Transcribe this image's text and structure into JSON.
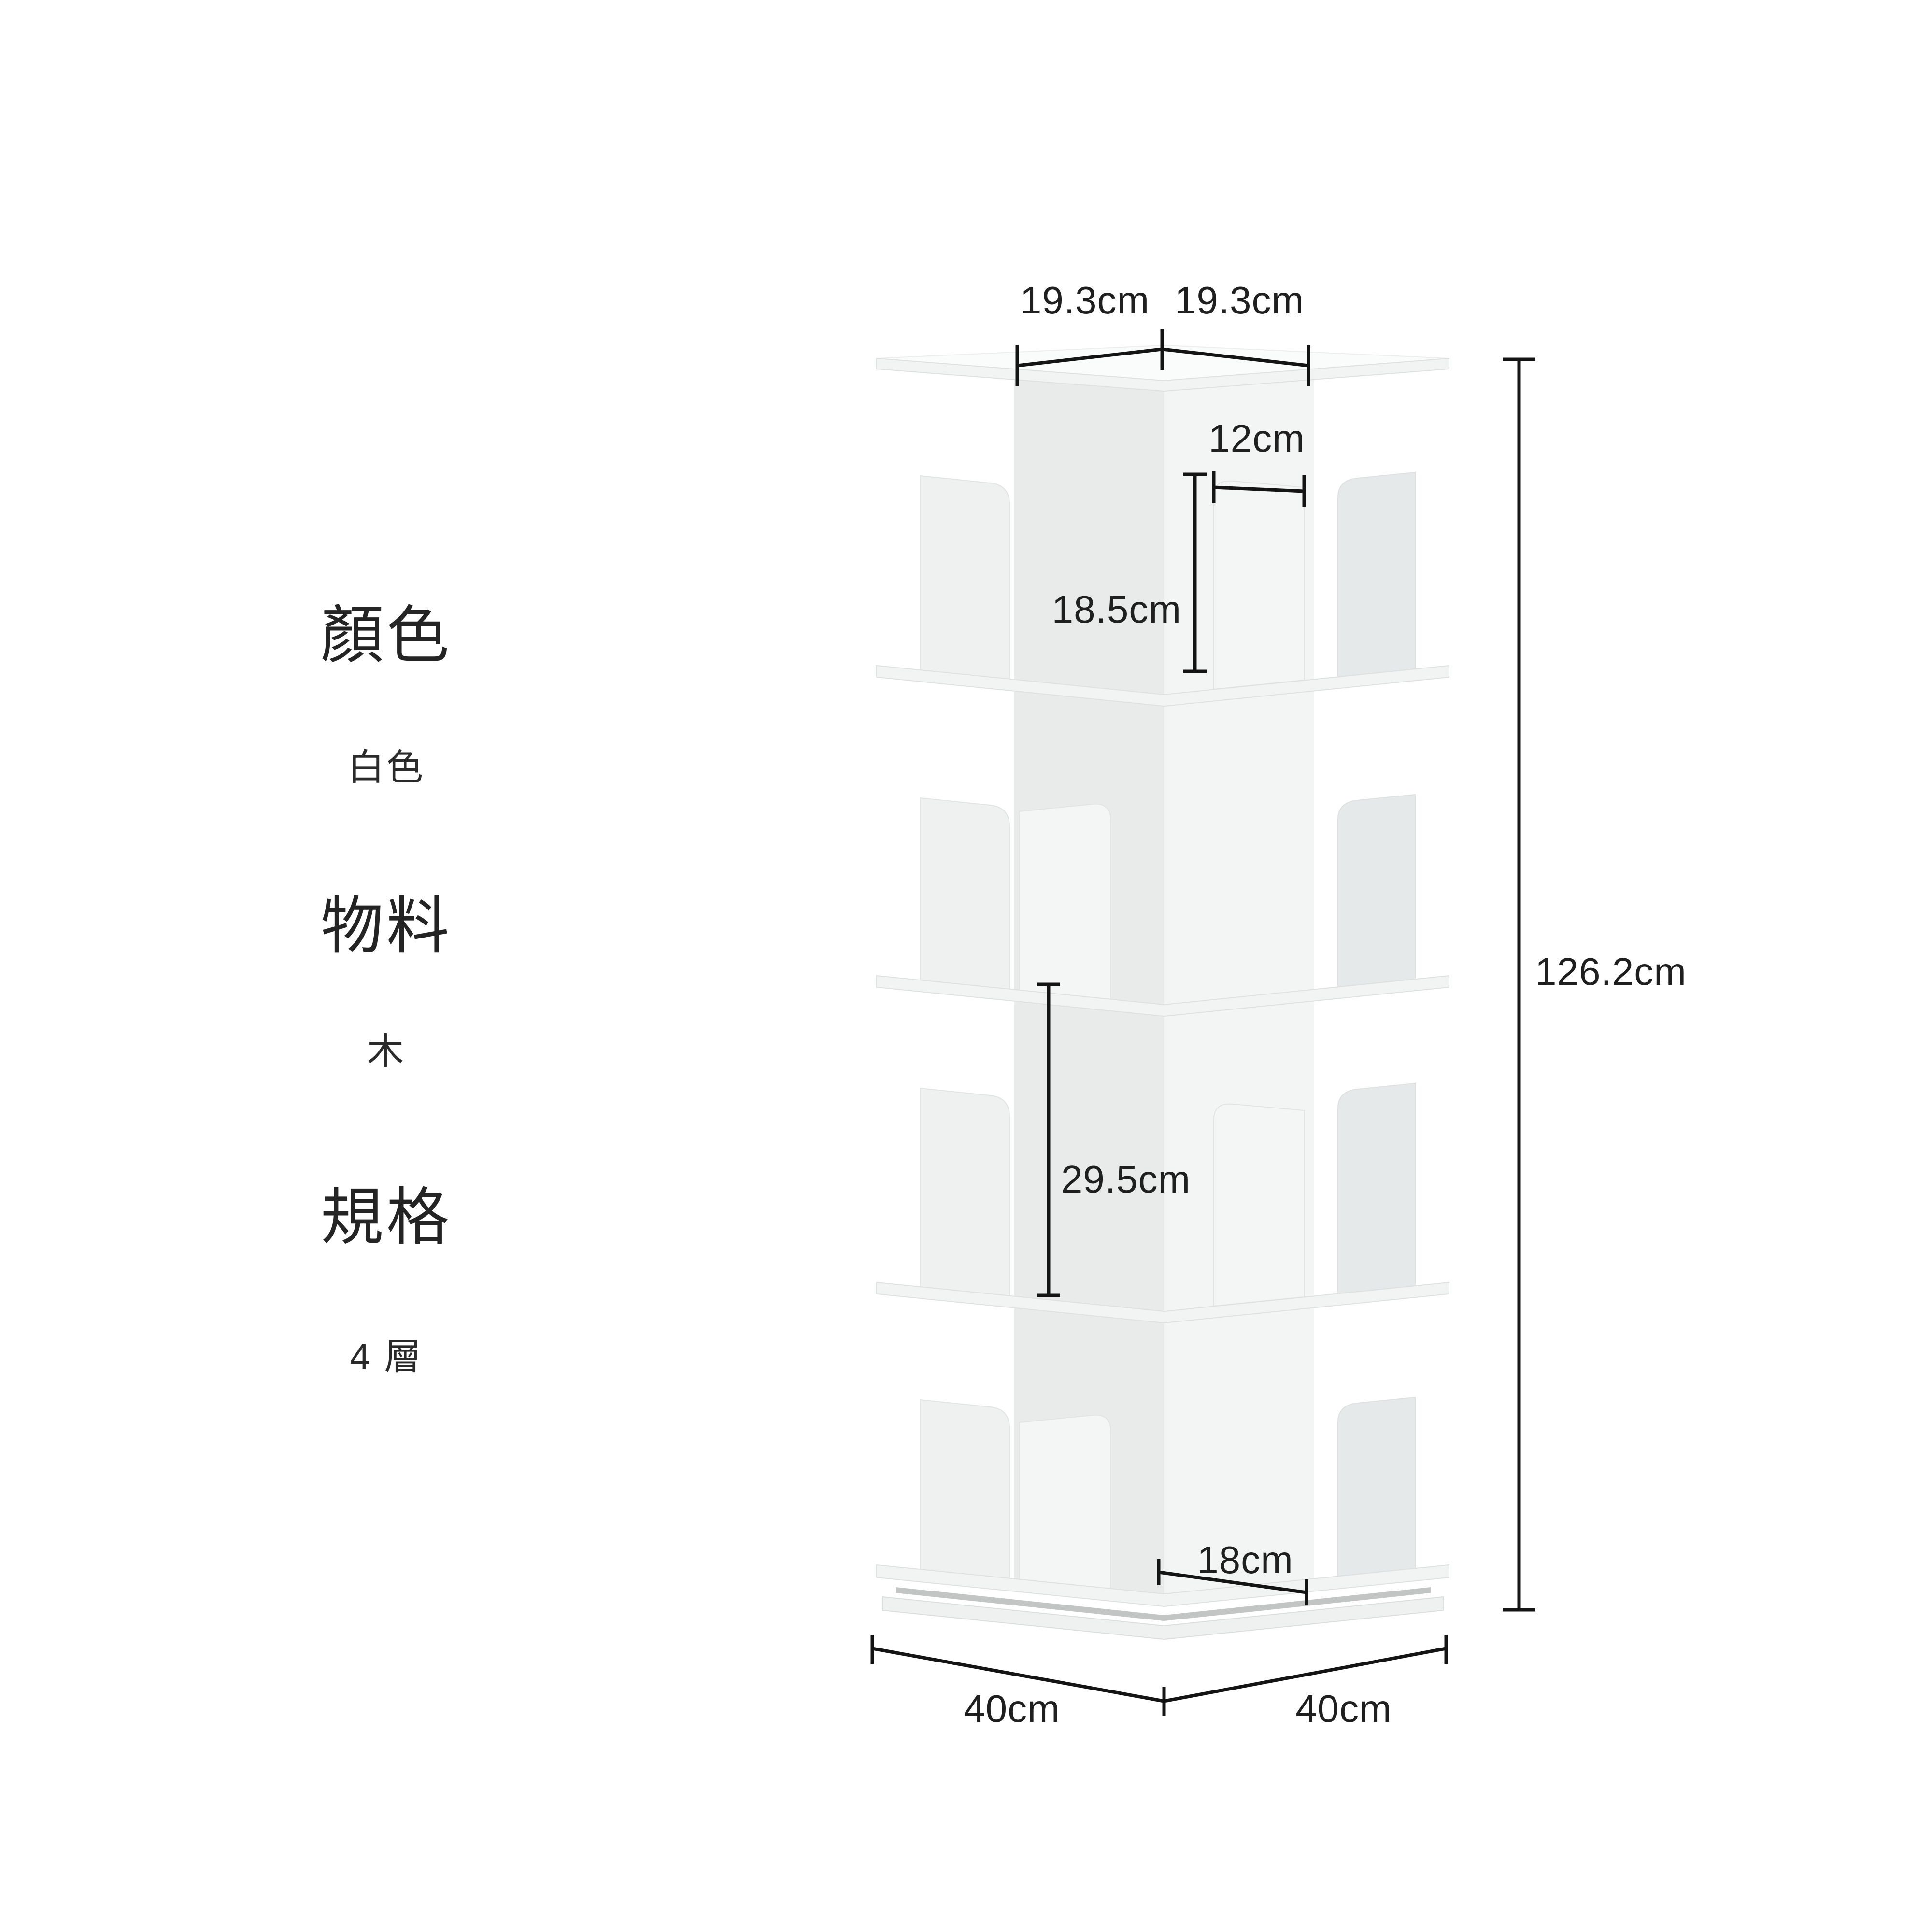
{
  "specs": {
    "items": [
      {
        "label": "顏色",
        "value": "白色"
      },
      {
        "label": "物料",
        "value": "木"
      },
      {
        "label": "規格",
        "value": "4 層"
      }
    ]
  },
  "dimensions": {
    "top_left_width": "19.3cm",
    "top_right_width": "19.3cm",
    "divider_width": "12cm",
    "divider_height": "18.5cm",
    "tier_inner_height": "29.5cm",
    "total_height": "126.2cm",
    "base_inner_width": "18cm",
    "base_left_width": "40cm",
    "base_right_width": "40cm"
  },
  "illustration": {
    "name": "4-tier rotating corner bookshelf, white, three-quarter view"
  },
  "colors": {
    "background": "#ffffff",
    "dimension_line": "#141414",
    "text": "#242424",
    "shelf_body": "#f2f3f3",
    "wall_shaded": "#eaecec"
  }
}
